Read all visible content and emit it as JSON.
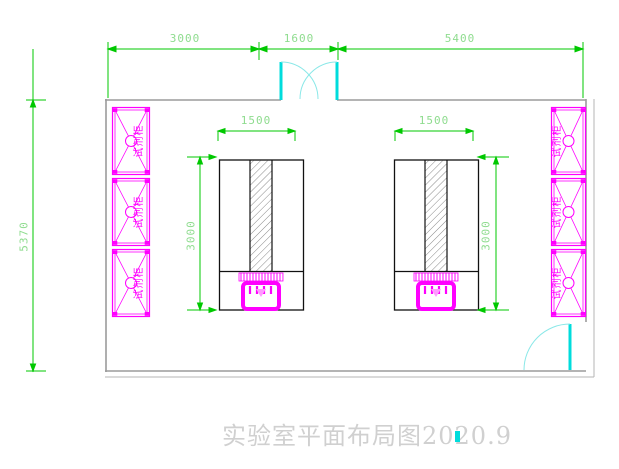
{
  "drawing": {
    "title": "实验室平面布局图2020.9",
    "type_note": "laboratory floor plan"
  },
  "dimensions": {
    "top": [
      {
        "label": "3000"
      },
      {
        "label": "1600"
      },
      {
        "label": "5400"
      }
    ],
    "left_total": {
      "label": "5370"
    },
    "left_bench": {
      "width_label": "1500",
      "depth_label": "3000"
    },
    "right_bench": {
      "width_label": "1500",
      "depth_label": "3000"
    }
  },
  "cabinets": {
    "left": [
      {
        "label": "试剂柜"
      },
      {
        "label": "试剂柜"
      },
      {
        "label": "试剂柜"
      }
    ],
    "right": [
      {
        "label": "试剂柜"
      },
      {
        "label": "试剂柜"
      },
      {
        "label": "试剂柜"
      }
    ]
  },
  "colors": {
    "dimension_line": "#00c800",
    "dimension_text": "#8fdc8f",
    "cabinet": "#ff00ff",
    "door": "#00dcdc",
    "wall": "#9b9b9b",
    "bench": "#111111",
    "title_text": "#d0d0d0"
  }
}
